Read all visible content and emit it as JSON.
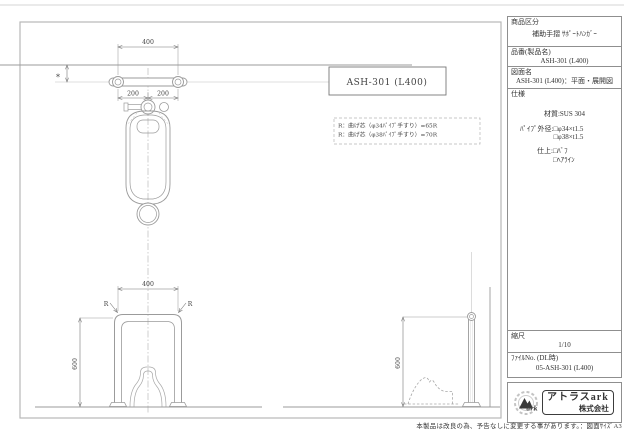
{
  "colors": {
    "drawing_line": "#9b9b9b",
    "dimension": "#777777",
    "frame": "#b8b8b8",
    "text": "#333333",
    "logo_dark": "#3a3a3a"
  },
  "title_block": {
    "product_category_label": "商品区分",
    "product_category_value": "補助手摺 ｻﾎﾟｰﾄﾊﾝｶﾞｰ",
    "product_number_label": "品番(製品名)",
    "product_number_value": "ASH-301 (L400)",
    "drawing_name_label": "図面名",
    "drawing_name_value": "ASH-301 (L400)：平面・展開図",
    "spec_label": "仕様",
    "spec_material": "材質:SUS 304",
    "spec_pipe_label": "ﾊﾟｲﾌﾟ外径:",
    "spec_pipe_option1": "□φ34×t1.5",
    "spec_pipe_option2": "□φ38×t1.5",
    "spec_finish_label": "仕上:",
    "spec_finish_option1": "□ﾊﾞﾌ",
    "spec_finish_option2": "□ﾍｱﾗｲﾝ",
    "scale_label": "縮尺",
    "scale_value": "1/10",
    "file_no_label": "ﾌｧｲﾙNo. (DL時)",
    "file_no_value": "05-ASH-301 (L400)",
    "company_name": "アトラスark",
    "company_suffix": "株式会社",
    "company_logo_text": "ark"
  },
  "drawing": {
    "part_label": "ASH-301 (L400)",
    "note_line1": "R：曲げ芯（φ34ﾊﾟｲﾌﾟ手すり）=65R",
    "note_line2": "R：曲げ芯（φ38ﾊﾟｲﾌﾟ手すり）=70R",
    "dim_plan_width": "400",
    "dim_plan_left": "200",
    "dim_plan_right": "200",
    "dim_wall_offset": "*",
    "dim_front_width": "400",
    "dim_front_height": "600",
    "dim_side_height": "600",
    "radius_label_left": "R",
    "radius_label_right": "R"
  },
  "footer": {
    "disclaimer": "本製品は改良の為、予告なしに変更する事があります。：図面ｻｲｽﾞA3"
  }
}
